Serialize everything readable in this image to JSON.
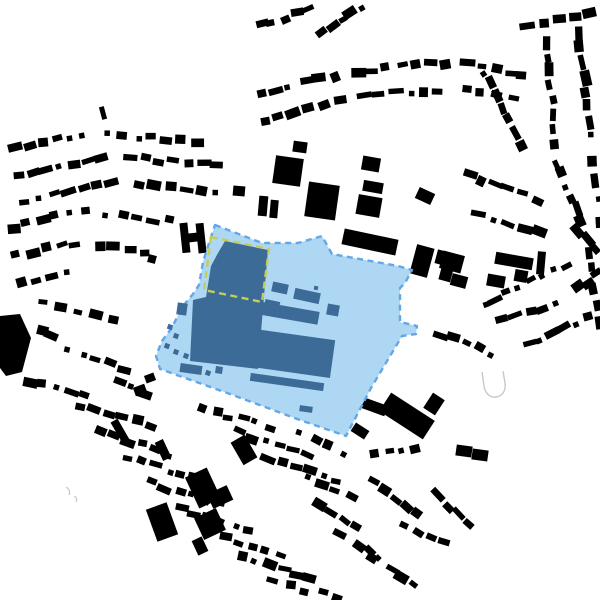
{
  "map": {
    "description": "figure-ground-site-plan",
    "width": 600,
    "height": 600,
    "seed": 1337,
    "colors": {
      "background": "#ffffff",
      "building_black": "#000000",
      "site_fill": "#aed7f3",
      "site_border": "#63a7e6",
      "site_building": "#3c6b98",
      "highlight_dash": "#c6cd55",
      "outline_gray": "#c9c9c9"
    },
    "site": {
      "outline": [
        [
          215,
          225
        ],
        [
          262,
          243
        ],
        [
          298,
          243
        ],
        [
          322,
          236
        ],
        [
          332,
          254
        ],
        [
          398,
          266
        ],
        [
          412,
          270
        ],
        [
          405,
          283
        ],
        [
          400,
          288
        ],
        [
          400,
          322
        ],
        [
          417,
          326
        ],
        [
          416,
          334
        ],
        [
          402,
          336
        ],
        [
          371,
          388
        ],
        [
          346,
          436
        ],
        [
          300,
          420
        ],
        [
          230,
          394
        ],
        [
          160,
          369
        ],
        [
          156,
          356
        ],
        [
          162,
          341
        ],
        [
          171,
          329
        ],
        [
          183,
          306
        ],
        [
          193,
          294
        ],
        [
          199,
          285
        ],
        [
          203,
          262
        ],
        [
          208,
          246
        ]
      ],
      "main_mass": [
        [
          225,
          241
        ],
        [
          268,
          250
        ],
        [
          263,
          308
        ],
        [
          258,
          369
        ],
        [
          190,
          361
        ],
        [
          193,
          300
        ],
        [
          206,
          297
        ],
        [
          211,
          266
        ],
        [
          218,
          253
        ]
      ],
      "buildings": [
        [
          280,
          288,
          16,
          10,
          12
        ],
        [
          307,
          296,
          26,
          11,
          12
        ],
        [
          316,
          288,
          4,
          4,
          12
        ],
        [
          272,
          305,
          15,
          9,
          12
        ],
        [
          288,
          313,
          62,
          13,
          10
        ],
        [
          333,
          310,
          12,
          11,
          10
        ],
        [
          289,
          353,
          88,
          38,
          8
        ],
        [
          287,
          382,
          74,
          8,
          8
        ],
        [
          306,
          409,
          13,
          6,
          8
        ],
        [
          191,
          369,
          22,
          9,
          8
        ],
        [
          219,
          370,
          7,
          7,
          8
        ],
        [
          182,
          309,
          10,
          12,
          8
        ]
      ],
      "dots": [
        [
          170,
          327
        ],
        [
          176,
          336
        ],
        [
          167,
          346
        ],
        [
          176,
          352
        ],
        [
          186,
          356
        ],
        [
          196,
          371
        ],
        [
          208,
          373
        ]
      ],
      "dot_size": 5,
      "highlight_rect": [
        [
          211,
          237
        ],
        [
          269,
          249
        ],
        [
          262,
          302
        ],
        [
          204,
          290
        ]
      ]
    },
    "landmarks": [
      [
        288,
        171,
        28,
        28,
        8
      ],
      [
        300,
        147,
        14,
        11,
        8
      ],
      [
        322,
        201,
        31,
        35,
        8
      ],
      [
        371,
        164,
        18,
        14,
        10
      ],
      [
        373,
        187,
        20,
        11,
        10
      ],
      [
        369,
        206,
        24,
        20,
        10
      ],
      [
        425,
        196,
        17,
        12,
        25
      ],
      [
        239,
        191,
        12,
        10,
        5
      ],
      [
        263,
        206,
        9,
        20,
        5
      ],
      [
        274,
        209,
        8,
        18,
        5
      ],
      [
        370,
        242,
        55,
        16,
        12
      ],
      [
        422,
        261,
        18,
        30,
        15
      ],
      [
        443,
        258,
        14,
        14,
        15
      ],
      [
        446,
        274,
        12,
        14,
        15
      ],
      [
        407,
        416,
        52,
        22,
        33
      ],
      [
        372,
        406,
        30,
        11,
        20
      ],
      [
        434,
        404,
        14,
        18,
        33
      ],
      [
        360,
        431,
        16,
        10,
        33
      ],
      [
        464,
        451,
        16,
        11,
        8
      ],
      [
        480,
        455,
        16,
        11,
        8
      ],
      [
        452,
        262,
        22,
        18,
        15
      ],
      [
        459,
        281,
        16,
        12,
        15
      ],
      [
        514,
        261,
        38,
        12,
        10
      ],
      [
        496,
        281,
        18,
        12,
        10
      ],
      [
        521,
        276,
        13,
        12,
        10
      ],
      [
        541,
        263,
        8,
        23,
        5
      ],
      [
        162,
        522,
        22,
        34,
        -20
      ],
      [
        203,
        488,
        24,
        34,
        -25
      ],
      [
        220,
        497,
        22,
        16,
        -25
      ],
      [
        210,
        524,
        24,
        24,
        -25
      ],
      [
        200,
        546,
        11,
        16,
        -25
      ],
      [
        163,
        450,
        9,
        20,
        -25
      ],
      [
        120,
        431,
        8,
        24,
        -30
      ],
      [
        244,
        450,
        16,
        26,
        -30
      ],
      [
        103,
        113,
        5,
        13,
        -15
      ],
      [
        152,
        259,
        8,
        8,
        15
      ],
      [
        150,
        378,
        10,
        8,
        -20
      ],
      [
        140,
        390,
        12,
        9,
        -20
      ]
    ],
    "left_blob": [
      [
        0,
        316
      ],
      [
        20,
        314
      ],
      [
        31,
        338
      ],
      [
        22,
        372
      ],
      [
        6,
        376
      ],
      [
        0,
        368
      ]
    ],
    "h_building": {
      "points": [
        [
          181,
          222
        ],
        [
          189,
          222
        ],
        [
          189,
          233
        ],
        [
          197,
          233
        ],
        [
          197,
          224
        ],
        [
          205,
          224
        ],
        [
          205,
          254
        ],
        [
          197,
          254
        ],
        [
          197,
          242
        ],
        [
          189,
          242
        ],
        [
          189,
          252
        ],
        [
          181,
          252
        ]
      ],
      "rotate": [
        -6,
        193,
        238
      ]
    },
    "u_outline": "M 482,372 l 2,14 c 1,7 6,12 12,11 c 7,-1 10,-7 9,-14 l -2,-12",
    "gray_marks": [
      "M 66,487 q 5,3 3,8",
      "M 74,496 q 4,2 2,6"
    ],
    "fabric_rows": [
      [
        10,
        150,
        90,
        133,
        6
      ],
      [
        100,
        133,
        205,
        143,
        7
      ],
      [
        10,
        176,
        110,
        157,
        7
      ],
      [
        122,
        157,
        225,
        167,
        7
      ],
      [
        15,
        202,
        120,
        182,
        7
      ],
      [
        132,
        183,
        222,
        194,
        6
      ],
      [
        5,
        228,
        92,
        209,
        6
      ],
      [
        98,
        212,
        178,
        222,
        5
      ],
      [
        10,
        256,
        82,
        241,
        5
      ],
      [
        92,
        246,
        152,
        252,
        4
      ],
      [
        15,
        286,
        72,
        273,
        4
      ],
      [
        252,
        96,
        342,
        73,
        6
      ],
      [
        352,
        71,
        450,
        63,
        7
      ],
      [
        460,
        63,
        530,
        76,
        5
      ],
      [
        257,
        121,
        347,
        99,
        6
      ],
      [
        357,
        96,
        447,
        89,
        6
      ],
      [
        457,
        89,
        520,
        101,
        4
      ],
      [
        255,
        26,
        312,
        9,
        5
      ],
      [
        318,
        36,
        366,
        6,
        5
      ],
      [
        520,
        26,
        596,
        13,
        5
      ],
      [
        546,
        36,
        556,
        150,
        8
      ],
      [
        577,
        26,
        592,
        142,
        8
      ],
      [
        556,
        156,
        582,
        228,
        6
      ],
      [
        592,
        152,
        600,
        230,
        4
      ],
      [
        482,
        66,
        522,
        150,
        7
      ],
      [
        462,
        172,
        542,
        202,
        6
      ],
      [
        472,
        212,
        546,
        236,
        5
      ],
      [
        478,
        306,
        573,
        263,
        8
      ],
      [
        497,
        322,
        562,
        302,
        5
      ],
      [
        522,
        346,
        596,
        316,
        6
      ],
      [
        572,
        291,
        600,
        272,
        3
      ],
      [
        436,
        331,
        497,
        356,
        5
      ],
      [
        590,
        242,
        600,
        332,
        5
      ],
      [
        572,
        226,
        600,
        252,
        3
      ],
      [
        370,
        456,
        422,
        446,
        4
      ],
      [
        368,
        479,
        421,
        516,
        5
      ],
      [
        396,
        521,
        451,
        546,
        4
      ],
      [
        432,
        491,
        471,
        531,
        4
      ],
      [
        362,
        546,
        421,
        591,
        5
      ],
      [
        76,
        406,
        156,
        426,
        6
      ],
      [
        96,
        431,
        176,
        456,
        6
      ],
      [
        122,
        456,
        202,
        481,
        6
      ],
      [
        146,
        481,
        226,
        506,
        6
      ],
      [
        176,
        506,
        256,
        531,
        6
      ],
      [
        206,
        531,
        286,
        556,
        6
      ],
      [
        236,
        556,
        316,
        581,
        6
      ],
      [
        266,
        581,
        346,
        599,
        5
      ],
      [
        196,
        406,
        276,
        429,
        6
      ],
      [
        232,
        431,
        312,
        456,
        6
      ],
      [
        262,
        456,
        342,
        481,
        6
      ],
      [
        292,
        431,
        352,
        456,
        4
      ],
      [
        312,
        501,
        362,
        531,
        4
      ],
      [
        332,
        531,
        382,
        561,
        3
      ],
      [
        302,
        476,
        357,
        499,
        4
      ],
      [
        36,
        301,
        122,
        321,
        5
      ],
      [
        62,
        346,
        132,
        371,
        5
      ],
      [
        22,
        381,
        92,
        396,
        5
      ],
      [
        112,
        381,
        152,
        396,
        3
      ],
      [
        36,
        331,
        58,
        339,
        2
      ]
    ],
    "fabric_house_size": 11
  }
}
